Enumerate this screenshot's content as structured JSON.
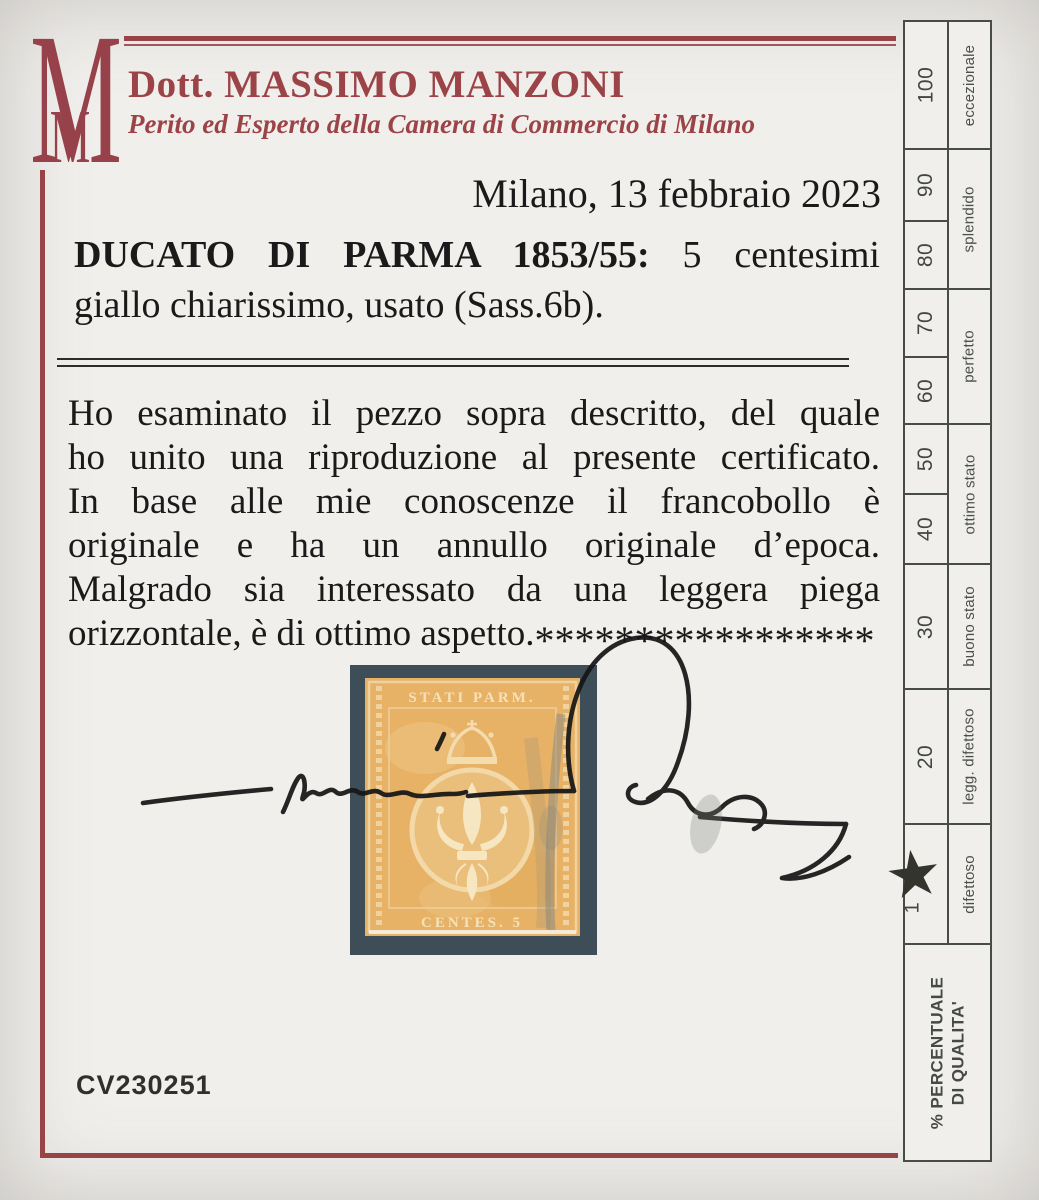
{
  "header": {
    "logo_monogram_large": "M",
    "logo_monogram_small": "M",
    "name": "Dott. MASSIMO MANZONI",
    "subtitle": "Perito ed Esperto della Camera di Commercio di Milano",
    "accent_color": "#9c4348"
  },
  "date_line": "Milano, 13 febbraio 2023",
  "description": {
    "bold": "DUCATO DI PARMA 1853/55:",
    "rest": "5 centesimi",
    "line2": "giallo chiarissimo, usato (Sass.6b)."
  },
  "body": {
    "lines": [
      "Ho esaminato il pezzo sopra descritto, del quale",
      "ho unito una riproduzione al presente certificato.",
      "In base alle mie conoscenze il francobollo è",
      "originale e ha un annullo originale d’epoca.",
      "Malgrado sia interessato da una leggera piega",
      "orizzontale, è di ottimo aspetto."
    ],
    "asterisks": "*****************"
  },
  "stamp": {
    "inscription_top": "STATI PARM.",
    "inscription_bottom": "CENTES. 5",
    "mount_color": "#3e4e59",
    "paper_color": "#e7b266"
  },
  "certificate_number": "CV230251",
  "quality_scale": {
    "values": [
      "100",
      "90",
      "80",
      "70",
      "60",
      "50",
      "40",
      "30",
      "20"
    ],
    "star_number": "1",
    "star_icon": "★",
    "labels": {
      "eccezionale": "eccezionale",
      "splendido": "splendido",
      "perfetto": "perfetto",
      "ottimo_stato": "ottimo stato",
      "buono_stato": "buono stato",
      "legg_difettoso": "legg. difettoso",
      "difettoso": "difettoso"
    },
    "footer_line1": "% PERCENTUALE",
    "footer_line2": "DI QUALITA'"
  }
}
